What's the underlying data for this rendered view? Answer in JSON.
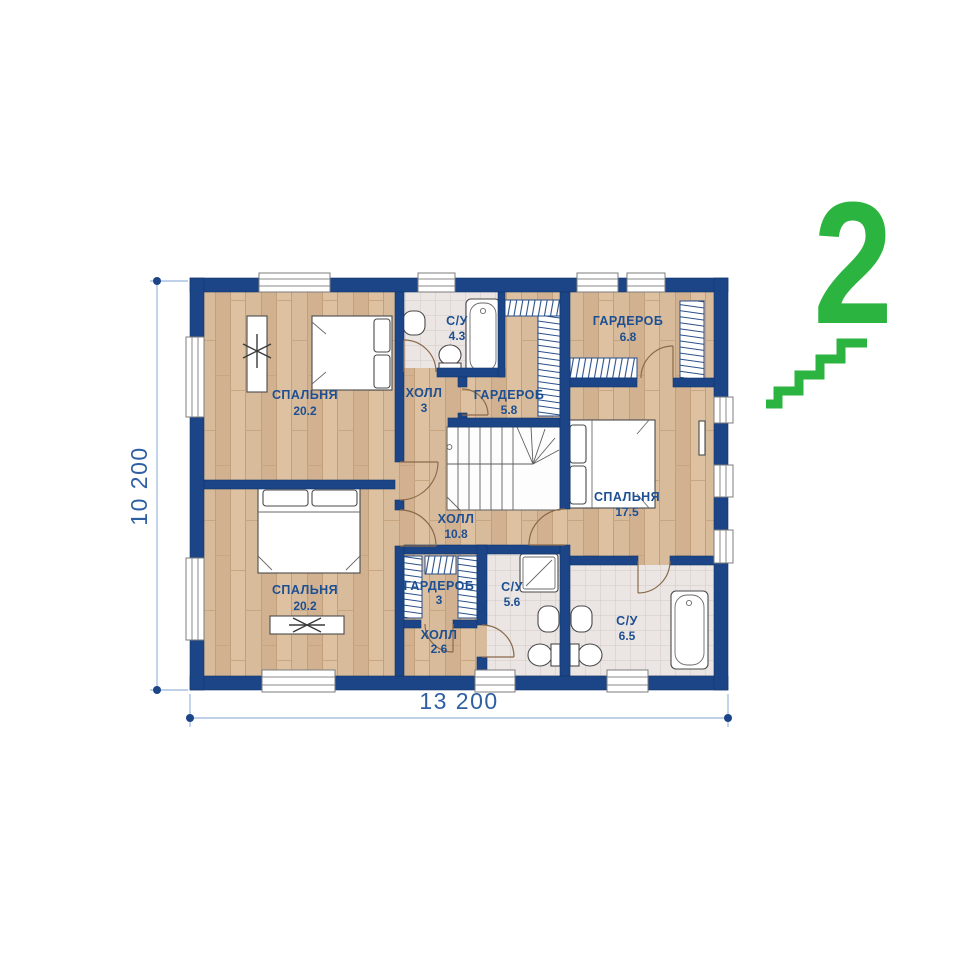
{
  "plan": {
    "title": "second-floor-plan",
    "floor_badge": {
      "number": "2"
    },
    "dimensions": {
      "width_label": "13 200",
      "height_label": "10 200"
    },
    "rooms": [
      {
        "name": "СПАЛЬНЯ",
        "area": "20.2"
      },
      {
        "name": "С/У",
        "area": "4.3"
      },
      {
        "name": "ХОЛЛ",
        "area": "3"
      },
      {
        "name": "ГАРДЕРОБ",
        "area": "5.8"
      },
      {
        "name": "ГАРДЕРОБ",
        "area": "6.8"
      },
      {
        "name": "СПАЛЬНЯ",
        "area": "17.5"
      },
      {
        "name": "ХОЛЛ",
        "area": "10.8"
      },
      {
        "name": "СПАЛЬНЯ",
        "area": "20.2"
      },
      {
        "name": "ГАРДЕРОБ",
        "area": "3"
      },
      {
        "name": "ХОЛЛ",
        "area": "2.6"
      },
      {
        "name": "С/У",
        "area": "5.6"
      },
      {
        "name": "С/У",
        "area": "6.5"
      }
    ],
    "colors": {
      "wall": "#1b4586",
      "label": "#1d4f93",
      "dimension_line": "#a9c2e2",
      "dimension_text": "#2f5fa3",
      "accent_green": "#2cb440",
      "wood_floor": "#d8bb9b",
      "tile_floor": "#ebe6e3"
    }
  }
}
